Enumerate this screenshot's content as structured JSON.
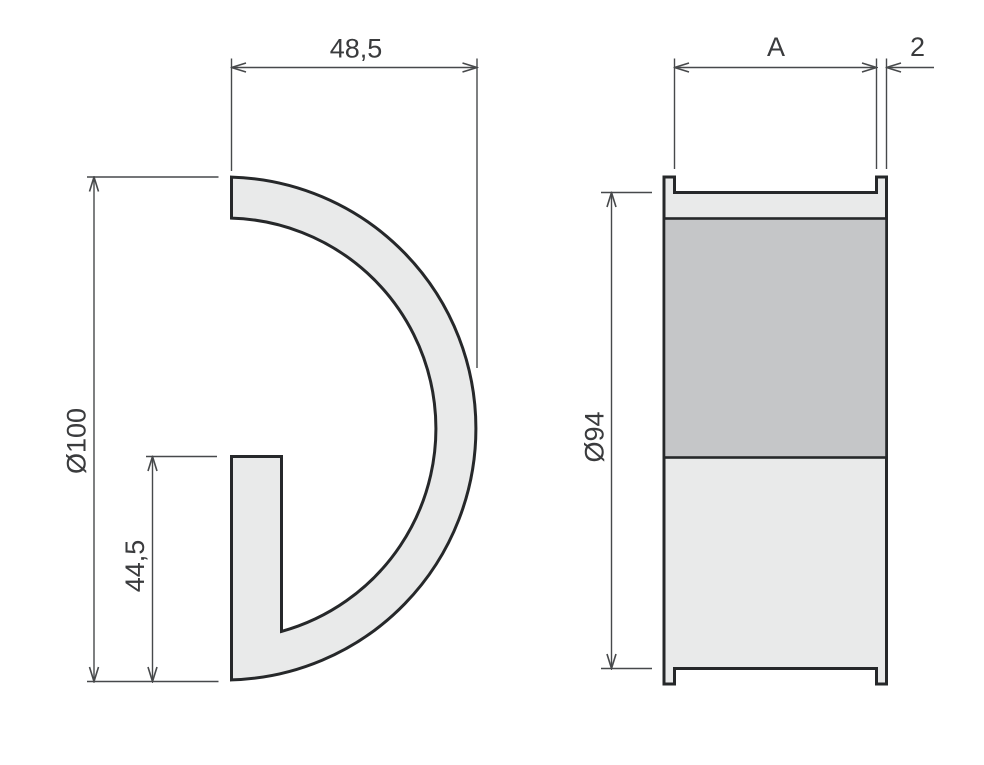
{
  "colors": {
    "outline": "#26282a",
    "dimension_line": "#47494b",
    "label_text": "#3a3b3d",
    "part_fill_light": "#e9eaea",
    "part_fill_dark": "#c5c6c8",
    "page_background": "#ffffff"
  },
  "left_view": {
    "dim_width": "48,5",
    "dim_outer_diameter": "Ø100",
    "dim_opening_height": "44,5"
  },
  "right_view": {
    "dim_barrel_length": "A",
    "dim_flange_width": "2",
    "dim_barrel_diameter": "Ø94"
  }
}
